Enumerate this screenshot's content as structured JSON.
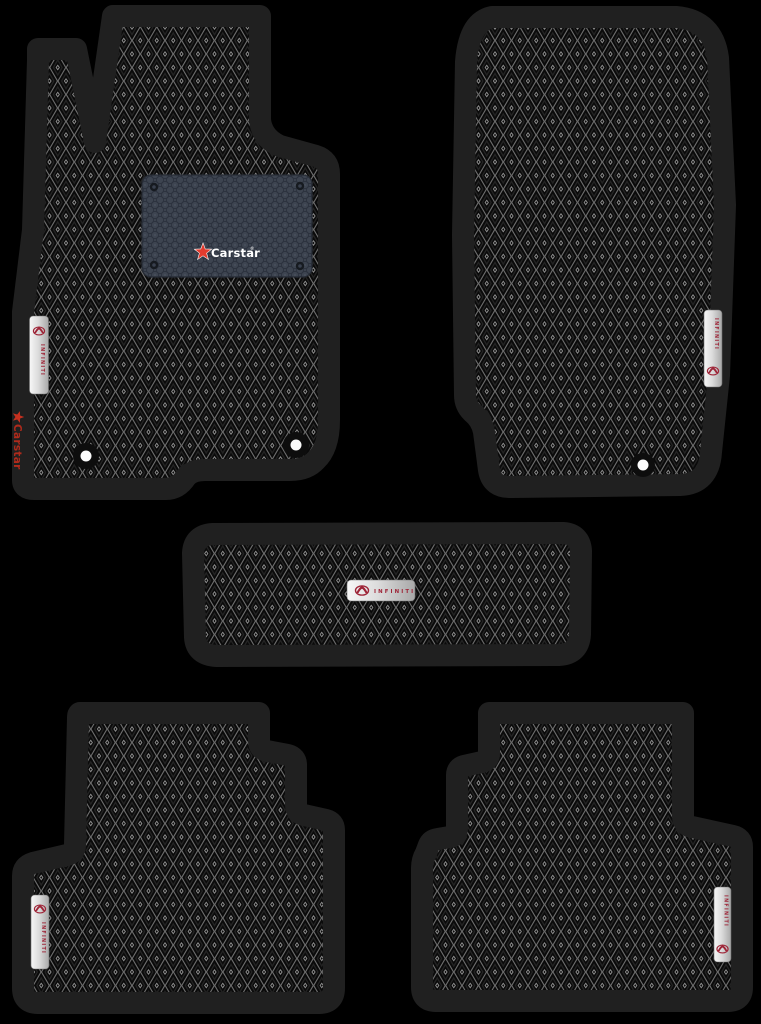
{
  "scene": {
    "type": "product-photo",
    "subject": "Set of five black EVA car floor mats with rhombus pattern",
    "background": "#000000"
  },
  "colors": {
    "mat_border": "#202020",
    "eva_grid_gray": "#6d6d6d",
    "eva_cell_black": "#0a0a0a",
    "heel_pad": "#3d4450",
    "brand_red": "#e23b2e",
    "side_logo_red": "#b02a1b",
    "infiniti_red": "#9e2437",
    "tag_silver": "#e8e8e8",
    "grommet_white": "#fbfbfb"
  },
  "branding": {
    "heel_logo": {
      "label": "Carstar",
      "registered": "®",
      "icon": "star-icon"
    },
    "side_logo": {
      "label": "Carstar",
      "icon": "star-icon"
    },
    "tag": {
      "label": "INFINITI",
      "icon": "infiniti-logo-icon"
    }
  }
}
